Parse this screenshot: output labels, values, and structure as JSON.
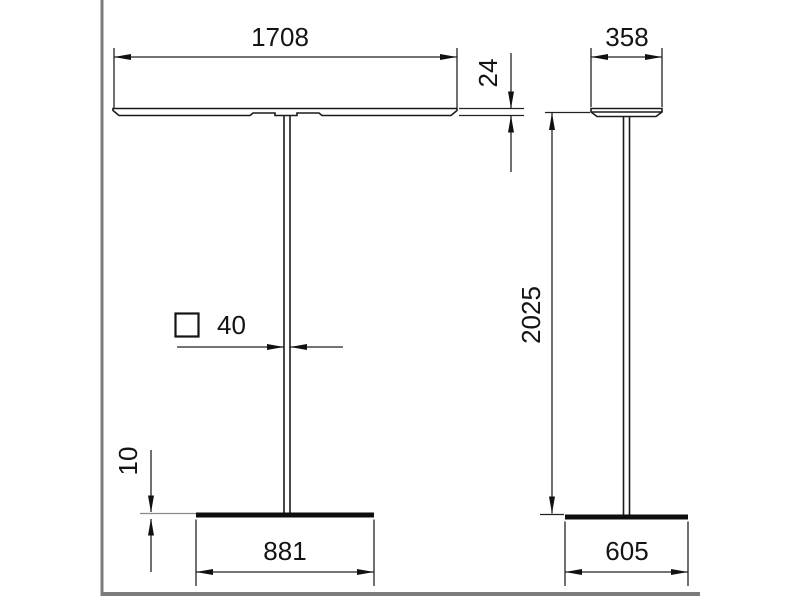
{
  "drawing": {
    "type": "dimensioned two-view technical drawing of a free-standing luminaire",
    "dimensions": {
      "head_width": "1708",
      "head_thickness": "24",
      "head_depth": "358",
      "total_height": "2025",
      "pole_square_section": "40",
      "base_plate_thickness": "10",
      "base_width": "881",
      "base_depth": "605"
    },
    "symbols": {
      "square_section": "square-outline"
    },
    "colors": {
      "line": "#1a1a1a",
      "dimension": "#222222",
      "frame": "#7c7c7c",
      "background": "#ffffff"
    }
  }
}
